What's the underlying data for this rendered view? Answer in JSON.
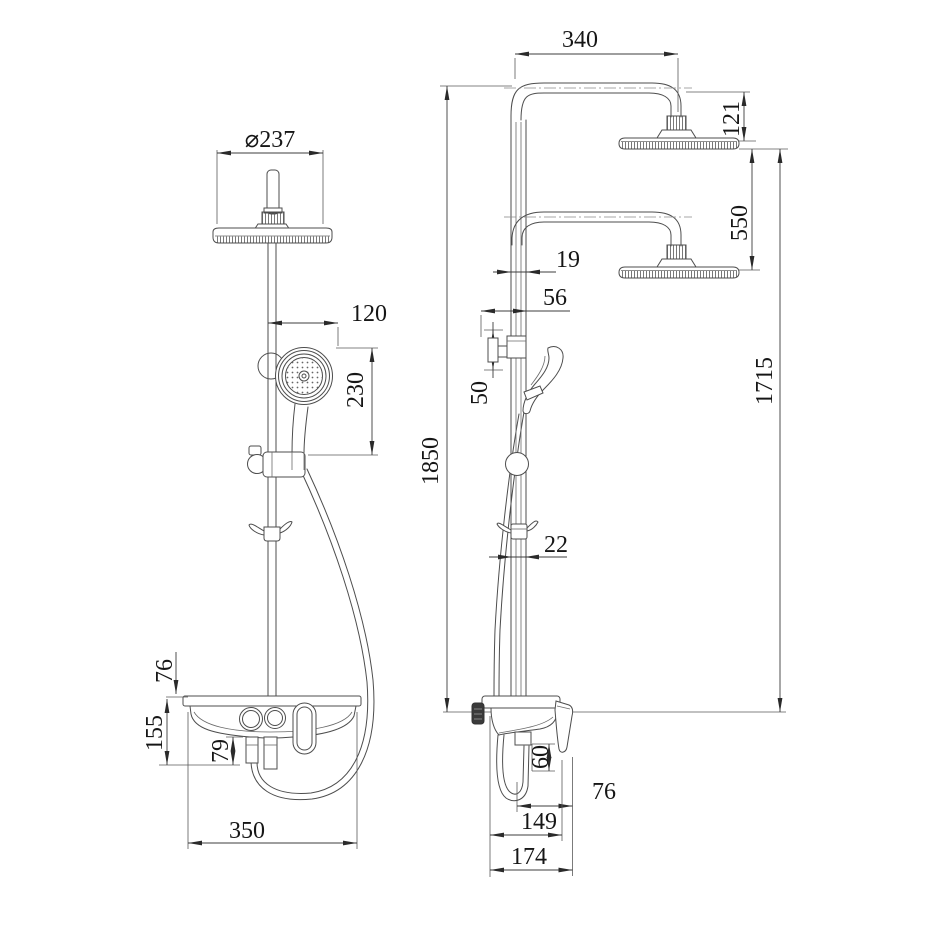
{
  "drawing": {
    "type": "technical-dimension-drawing",
    "subject": "shower-column-system-two-views",
    "background_color": "#ffffff",
    "line_color": "#4d4d4d",
    "front_view": {
      "dims": {
        "head_diameter": "⌀237",
        "handshower_offset": "120",
        "handshower_height": "230",
        "shelf_top_clearance": "76",
        "shelf_height": "155",
        "spout_drop": "79",
        "shelf_width": "350"
      }
    },
    "side_view": {
      "dims": {
        "column_height": "1850",
        "arm_reach": "340",
        "head_drop": "121",
        "head_travel": "550",
        "head_to_mixer": "1715",
        "pipe_width_upper": "19",
        "diverter_offset": "56",
        "diverter_height": "50",
        "pipe_width_lower": "22",
        "hose_connector_drop": "60",
        "body_depth": "76",
        "mixer_depth": "149",
        "total_depth": "174"
      }
    }
  }
}
